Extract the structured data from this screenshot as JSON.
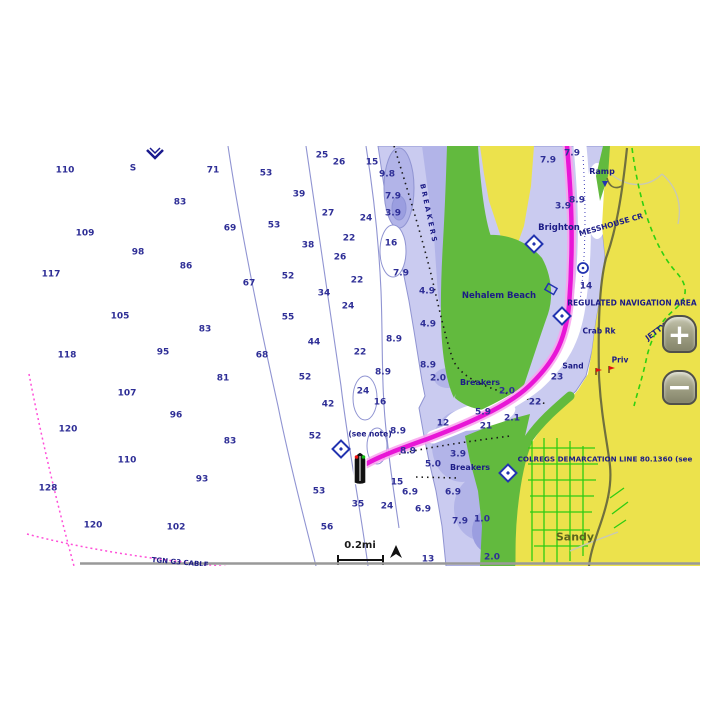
{
  "chartplotter": {
    "zoom_controls": {
      "zoom_in_label": "+",
      "zoom_out_label": "−"
    },
    "colors": {
      "water_deep": "#ffffff",
      "shallow_light": "#cacbf0",
      "shallow_mid": "#b2b4e8",
      "shallow_dark": "#9b9ee0",
      "intertidal_green": "#62ba3e",
      "land_yellow": "#ece24c",
      "route_magenta": "#e816d6",
      "contour_blue": "#9094d2",
      "sounding_navy": "#2e2e96",
      "label_navy": "#1c1c86",
      "road_olive": "#70703e",
      "street_green": "#2ecc12",
      "cable_magenta": "#ff4fd8",
      "colregs_green": "#2fd010",
      "button_face": "#9a9a80"
    },
    "soundings": [
      [
        55,
        25,
        "110"
      ],
      [
        203,
        25,
        "71"
      ],
      [
        170,
        57,
        "83"
      ],
      [
        220,
        83,
        "69"
      ],
      [
        75,
        88,
        "109"
      ],
      [
        128,
        107,
        "98"
      ],
      [
        176,
        121,
        "86"
      ],
      [
        41,
        129,
        "117"
      ],
      [
        110,
        171,
        "105"
      ],
      [
        195,
        184,
        "83"
      ],
      [
        57,
        210,
        "118"
      ],
      [
        153,
        207,
        "95"
      ],
      [
        213,
        233,
        "81"
      ],
      [
        117,
        248,
        "107"
      ],
      [
        166,
        270,
        "96"
      ],
      [
        58,
        284,
        "120"
      ],
      [
        220,
        296,
        "83"
      ],
      [
        117,
        315,
        "110"
      ],
      [
        192,
        334,
        "93"
      ],
      [
        38,
        343,
        "128"
      ],
      [
        83,
        380,
        "120"
      ],
      [
        166,
        382,
        "102"
      ],
      [
        256,
        28,
        "53"
      ],
      [
        312,
        10,
        "25"
      ],
      [
        329,
        17,
        "26"
      ],
      [
        362,
        17,
        "15"
      ],
      [
        377,
        29,
        "9.8"
      ],
      [
        289,
        49,
        "39"
      ],
      [
        383,
        51,
        "7.9"
      ],
      [
        318,
        68,
        "27"
      ],
      [
        383,
        68,
        "3.9"
      ],
      [
        356,
        73,
        "24"
      ],
      [
        264,
        80,
        "53"
      ],
      [
        339,
        93,
        "22"
      ],
      [
        381,
        98,
        "16"
      ],
      [
        298,
        100,
        "38"
      ],
      [
        330,
        112,
        "26"
      ],
      [
        391,
        128,
        "7.9"
      ],
      [
        278,
        131,
        "52"
      ],
      [
        347,
        135,
        "22"
      ],
      [
        239,
        138,
        "67"
      ],
      [
        314,
        148,
        "34"
      ],
      [
        417,
        146,
        "4.9"
      ],
      [
        338,
        161,
        "24"
      ],
      [
        278,
        172,
        "55"
      ],
      [
        418,
        179,
        "4.9"
      ],
      [
        304,
        197,
        "44"
      ],
      [
        384,
        194,
        "8.9"
      ],
      [
        350,
        207,
        "22"
      ],
      [
        252,
        210,
        "68"
      ],
      [
        418,
        220,
        "8.9"
      ],
      [
        295,
        232,
        "52"
      ],
      [
        373,
        227,
        "8.9"
      ],
      [
        353,
        246,
        "24"
      ],
      [
        428,
        233,
        "2.0"
      ],
      [
        318,
        259,
        "42"
      ],
      [
        370,
        257,
        "16"
      ],
      [
        305,
        291,
        "52"
      ],
      [
        388,
        286,
        "8.9"
      ],
      [
        398,
        306,
        "8.9"
      ],
      [
        423,
        319,
        "5.0"
      ],
      [
        387,
        337,
        "15"
      ],
      [
        309,
        346,
        "53"
      ],
      [
        348,
        359,
        "35"
      ],
      [
        377,
        361,
        "24"
      ],
      [
        400,
        347,
        "6.9"
      ],
      [
        317,
        382,
        "56"
      ],
      [
        443,
        347,
        "6.9"
      ],
      [
        413,
        364,
        "6.9"
      ],
      [
        450,
        376,
        "7.9"
      ],
      [
        472,
        374,
        "1.0"
      ],
      [
        418,
        414,
        "13"
      ],
      [
        482,
        412,
        "2.0"
      ],
      [
        538,
        15,
        "7.9"
      ],
      [
        562,
        8,
        "7.9"
      ],
      [
        567,
        55,
        "8.9"
      ],
      [
        553,
        61,
        "3.9"
      ],
      [
        576,
        141,
        "14"
      ],
      [
        547,
        232,
        "23"
      ],
      [
        497,
        246,
        "2.0"
      ],
      [
        525,
        257,
        "22"
      ],
      [
        502,
        273,
        "2.1"
      ],
      [
        476,
        281,
        "21"
      ],
      [
        473,
        267,
        "5.9"
      ],
      [
        433,
        278,
        "12"
      ],
      [
        448,
        309,
        "3.9"
      ],
      [
        123,
        23,
        "S"
      ]
    ],
    "labels": [
      {
        "t": "BREAKERS",
        "x": 418,
        "y": 68,
        "s": 7,
        "r": 78,
        "ls": 2.5
      },
      {
        "t": "Ramp",
        "x": 592,
        "y": 26,
        "s": 8
      },
      {
        "t": "Brighton",
        "x": 549,
        "y": 82,
        "s": 8.5
      },
      {
        "t": "MESSHOUSE CR",
        "x": 601,
        "y": 79,
        "s": 7.5,
        "r": -16
      },
      {
        "t": "Nehalem Beach",
        "x": 489,
        "y": 150,
        "s": 8.5
      },
      {
        "t": "REGULATED NAVIGATION AREA",
        "x": 622,
        "y": 157,
        "s": 7.5
      },
      {
        "t": "Crab Rk",
        "x": 589,
        "y": 185,
        "s": 7.5
      },
      {
        "t": "JETTY",
        "x": 646,
        "y": 186,
        "s": 7.5,
        "r": -36
      },
      {
        "t": "Priv",
        "x": 610,
        "y": 214,
        "s": 7.5
      },
      {
        "t": "Sand",
        "x": 563,
        "y": 220,
        "s": 7.5
      },
      {
        "t": "Breakers",
        "x": 470,
        "y": 237,
        "s": 8
      },
      {
        "t": "Breakers",
        "x": 460,
        "y": 322,
        "s": 8
      },
      {
        "t": "(see note)",
        "x": 360,
        "y": 288,
        "s": 7.5
      },
      {
        "t": "COLREGS DEMARCATION LINE 80.1360 (see",
        "x": 595,
        "y": 313,
        "s": 7.2
      },
      {
        "t": "Sandy",
        "x": 565,
        "y": 391,
        "s": 11,
        "c": "#5a661c",
        "n": "town-label"
      },
      {
        "t": "TGN G3 CABLE",
        "x": 170,
        "y": 417,
        "s": 7,
        "r": 5
      },
      {
        "t": "0.2mi",
        "x": 350,
        "y": 400,
        "s": 10,
        "c": "#1a1a1a",
        "n": "scale-label"
      }
    ]
  }
}
